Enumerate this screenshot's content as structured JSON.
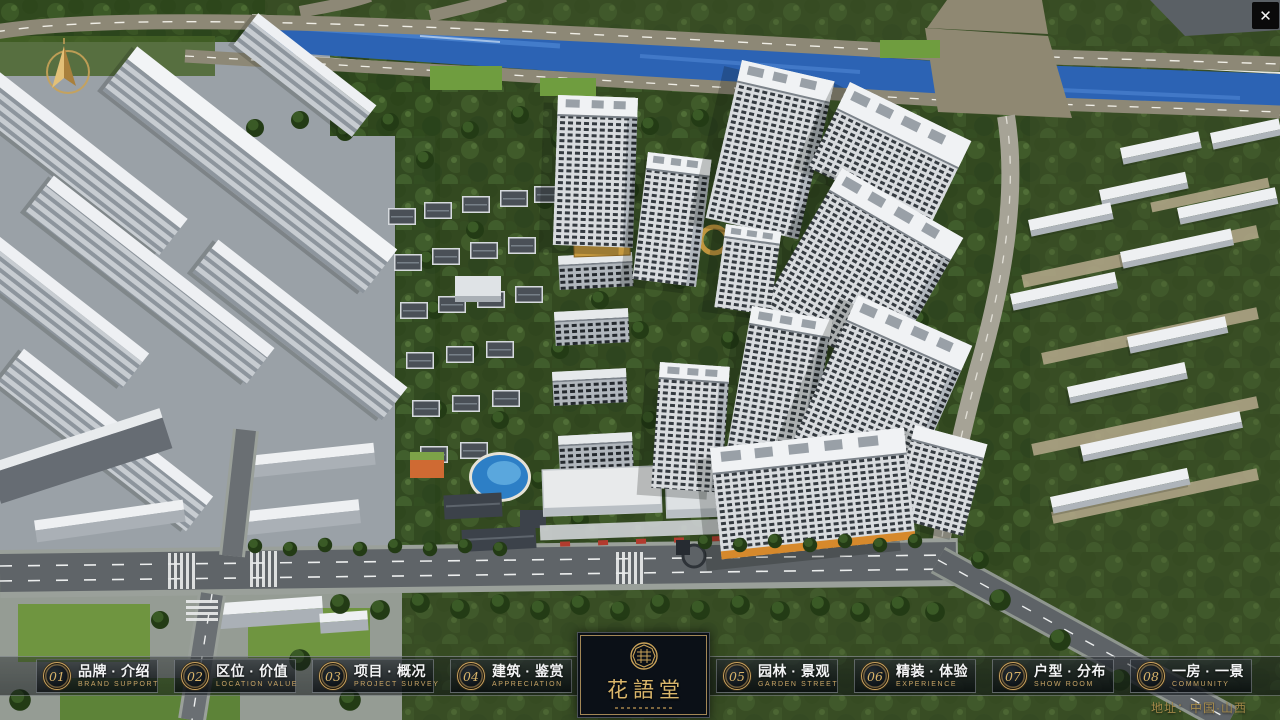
{
  "window": {
    "close_label": "✕"
  },
  "nav": {
    "items": [
      {
        "id": "brand-intro",
        "number": "01",
        "title": "品牌 · 介绍",
        "subtitle": "BRAND SUPPORT"
      },
      {
        "id": "location-value",
        "number": "02",
        "title": "区位 · 价值",
        "subtitle": "LOCATION VALUE"
      },
      {
        "id": "project-survey",
        "number": "03",
        "title": "项目 · 概况",
        "subtitle": "PROJECT SURVEY"
      },
      {
        "id": "architecture",
        "number": "04",
        "title": "建筑 · 鉴赏",
        "subtitle": "APPRECIATION"
      },
      {
        "id": "garden-view",
        "number": "05",
        "title": "园林 · 景观",
        "subtitle": "GARDEN STREET"
      },
      {
        "id": "experience",
        "number": "06",
        "title": "精装 · 体验",
        "subtitle": "EXPERIENCE"
      },
      {
        "id": "floor-plans",
        "number": "07",
        "title": "户型 · 分布",
        "subtitle": "SHOW ROOM"
      },
      {
        "id": "community",
        "number": "08",
        "title": "一房 · 一景",
        "subtitle": "COMMUNITY"
      }
    ]
  },
  "logo": {
    "title": "花語堂"
  },
  "footer": {
    "address": "地址：中国·山西"
  },
  "colors": {
    "gold": "#c9a566",
    "water": "#2c63b4",
    "navbar": "rgba(16,20,24,0.42)"
  }
}
